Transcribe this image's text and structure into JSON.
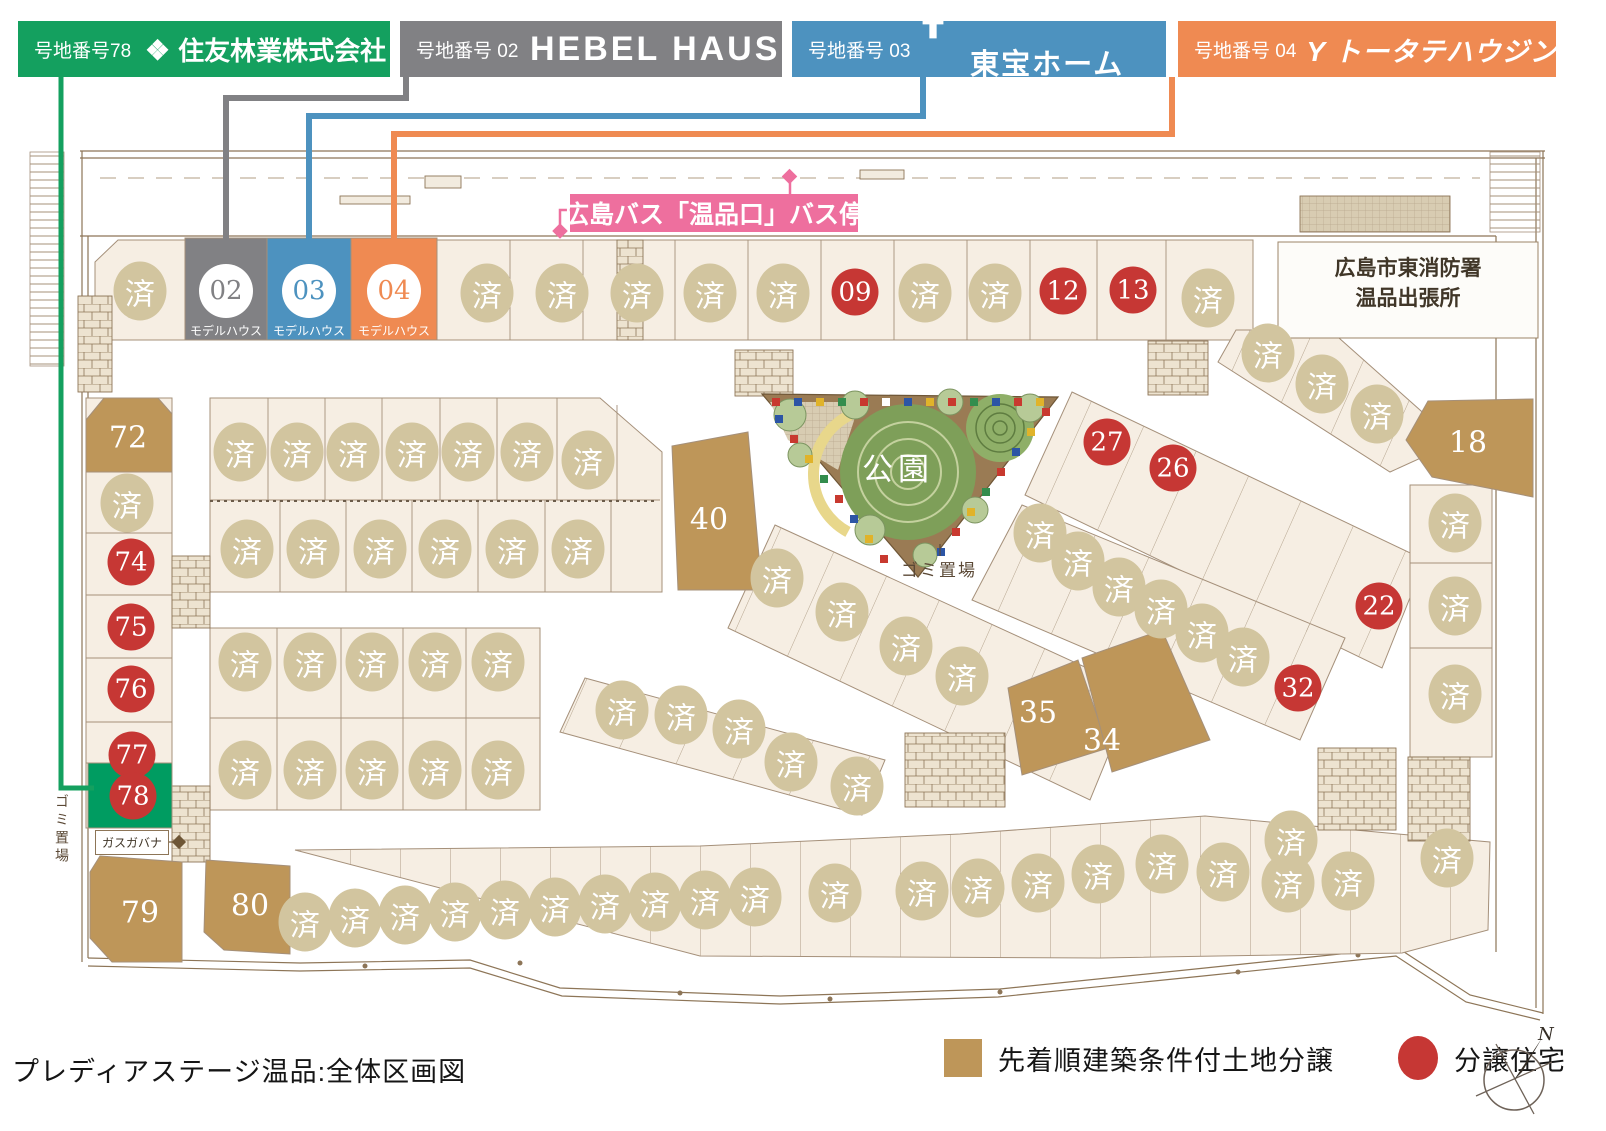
{
  "header": {
    "banners": [
      {
        "id": "sumitomo",
        "lot_label": "号地番号78",
        "company": "住友林業株式会社",
        "logo": "sumitomo-diamond-icon",
        "color": "#14A05F"
      },
      {
        "id": "hebel",
        "lot_label": "号地番号 02",
        "company": "HEBEL HAUS",
        "logo": "",
        "color": "#818184"
      },
      {
        "id": "toho",
        "lot_label": "号地番号 03",
        "company": "東宝ホーム",
        "logo": "toho-home-icon",
        "color": "#4D92BF"
      },
      {
        "id": "totate",
        "lot_label": "号地番号 04",
        "company": "トータテハウジング",
        "logo": "totate-y-icon",
        "color": "#EF8A52"
      }
    ]
  },
  "map": {
    "bus_stop_label": "広島バス「温品口」バス停",
    "bus_stop_color": "#EE6F9E",
    "fire_station": {
      "line1": "広島市東消防署",
      "line2": "温品出張所"
    },
    "park_label": "公園",
    "park_trash_label": "ゴミ置場",
    "left_trash_label": "ゴミ置場",
    "gas_label": "ガスガバナ",
    "model_caption": "モデルハウス",
    "sold_glyph": "済",
    "colors": {
      "sold_circle": "#D2C59F",
      "unit_red": "#C63734",
      "land_tan": "#BE9659",
      "lot78_green": "#009C61"
    },
    "lots": [
      {
        "t": "s",
        "x": 140,
        "y": 291
      },
      {
        "t": "s",
        "x": 487,
        "y": 293
      },
      {
        "t": "s",
        "x": 562,
        "y": 293
      },
      {
        "t": "s",
        "x": 637,
        "y": 293
      },
      {
        "t": "s",
        "x": 710,
        "y": 293
      },
      {
        "t": "s",
        "x": 783,
        "y": 293
      },
      {
        "t": "s",
        "x": 925,
        "y": 293
      },
      {
        "t": "s",
        "x": 995,
        "y": 293
      },
      {
        "t": "s",
        "x": 1208,
        "y": 298
      },
      {
        "t": "s",
        "x": 1268,
        "y": 353
      },
      {
        "t": "s",
        "x": 1322,
        "y": 384
      },
      {
        "t": "s",
        "x": 1377,
        "y": 414
      },
      {
        "t": "s",
        "x": 1455,
        "y": 523
      },
      {
        "t": "s",
        "x": 1455,
        "y": 606
      },
      {
        "t": "s",
        "x": 1455,
        "y": 694
      },
      {
        "t": "s",
        "x": 127,
        "y": 503
      },
      {
        "t": "s",
        "x": 240,
        "y": 452
      },
      {
        "t": "s",
        "x": 297,
        "y": 452
      },
      {
        "t": "s",
        "x": 353,
        "y": 452
      },
      {
        "t": "s",
        "x": 412,
        "y": 452
      },
      {
        "t": "s",
        "x": 468,
        "y": 452
      },
      {
        "t": "s",
        "x": 527,
        "y": 452
      },
      {
        "t": "s",
        "x": 588,
        "y": 460
      },
      {
        "t": "s",
        "x": 247,
        "y": 549
      },
      {
        "t": "s",
        "x": 313,
        "y": 549
      },
      {
        "t": "s",
        "x": 380,
        "y": 549
      },
      {
        "t": "s",
        "x": 445,
        "y": 549
      },
      {
        "t": "s",
        "x": 512,
        "y": 549
      },
      {
        "t": "s",
        "x": 578,
        "y": 549
      },
      {
        "t": "s",
        "x": 777,
        "y": 578
      },
      {
        "t": "s",
        "x": 842,
        "y": 612
      },
      {
        "t": "s",
        "x": 906,
        "y": 646
      },
      {
        "t": "s",
        "x": 962,
        "y": 676
      },
      {
        "t": "s",
        "x": 622,
        "y": 710
      },
      {
        "t": "s",
        "x": 681,
        "y": 715
      },
      {
        "t": "s",
        "x": 739,
        "y": 729
      },
      {
        "t": "s",
        "x": 791,
        "y": 762
      },
      {
        "t": "s",
        "x": 857,
        "y": 786
      },
      {
        "t": "s",
        "x": 1040,
        "y": 533
      },
      {
        "t": "s",
        "x": 1078,
        "y": 561
      },
      {
        "t": "s",
        "x": 1119,
        "y": 587
      },
      {
        "t": "s",
        "x": 1161,
        "y": 609
      },
      {
        "t": "s",
        "x": 1202,
        "y": 633
      },
      {
        "t": "s",
        "x": 1243,
        "y": 657
      },
      {
        "t": "s",
        "x": 245,
        "y": 662
      },
      {
        "t": "s",
        "x": 310,
        "y": 662
      },
      {
        "t": "s",
        "x": 372,
        "y": 662
      },
      {
        "t": "s",
        "x": 435,
        "y": 662
      },
      {
        "t": "s",
        "x": 498,
        "y": 662
      },
      {
        "t": "s",
        "x": 245,
        "y": 770
      },
      {
        "t": "s",
        "x": 310,
        "y": 770
      },
      {
        "t": "s",
        "x": 372,
        "y": 770
      },
      {
        "t": "s",
        "x": 435,
        "y": 770
      },
      {
        "t": "s",
        "x": 498,
        "y": 770
      },
      {
        "t": "s",
        "x": 305,
        "y": 922
      },
      {
        "t": "s",
        "x": 355,
        "y": 918
      },
      {
        "t": "s",
        "x": 405,
        "y": 915
      },
      {
        "t": "s",
        "x": 455,
        "y": 912
      },
      {
        "t": "s",
        "x": 505,
        "y": 910
      },
      {
        "t": "s",
        "x": 555,
        "y": 907
      },
      {
        "t": "s",
        "x": 605,
        "y": 904
      },
      {
        "t": "s",
        "x": 655,
        "y": 902
      },
      {
        "t": "s",
        "x": 705,
        "y": 900
      },
      {
        "t": "s",
        "x": 755,
        "y": 897
      },
      {
        "t": "s",
        "x": 835,
        "y": 893
      },
      {
        "t": "s",
        "x": 922,
        "y": 891
      },
      {
        "t": "s",
        "x": 978,
        "y": 888
      },
      {
        "t": "s",
        "x": 1038,
        "y": 883
      },
      {
        "t": "s",
        "x": 1098,
        "y": 874
      },
      {
        "t": "s",
        "x": 1162,
        "y": 864
      },
      {
        "t": "s",
        "x": 1223,
        "y": 872
      },
      {
        "t": "s",
        "x": 1288,
        "y": 883
      },
      {
        "t": "s",
        "x": 1348,
        "y": 881
      },
      {
        "t": "s",
        "x": 1291,
        "y": 840
      },
      {
        "t": "s",
        "x": 1447,
        "y": 858
      },
      {
        "t": "u",
        "l": "09",
        "x": 855,
        "y": 292
      },
      {
        "t": "u",
        "l": "12",
        "x": 1063,
        "y": 291
      },
      {
        "t": "u",
        "l": "13",
        "x": 1133,
        "y": 290
      },
      {
        "t": "u",
        "l": "22",
        "x": 1379,
        "y": 606
      },
      {
        "t": "u",
        "l": "26",
        "x": 1173,
        "y": 468
      },
      {
        "t": "u",
        "l": "27",
        "x": 1107,
        "y": 442
      },
      {
        "t": "u",
        "l": "32",
        "x": 1298,
        "y": 688
      },
      {
        "t": "u",
        "l": "74",
        "x": 131,
        "y": 562
      },
      {
        "t": "u",
        "l": "75",
        "x": 131,
        "y": 627
      },
      {
        "t": "u",
        "l": "76",
        "x": 131,
        "y": 689
      },
      {
        "t": "u",
        "l": "77",
        "x": 132,
        "y": 755
      },
      {
        "t": "u",
        "l": "78",
        "x": 133,
        "y": 796
      },
      {
        "t": "l",
        "l": "72",
        "x": 128,
        "y": 438
      },
      {
        "t": "l",
        "l": "18",
        "x": 1468,
        "y": 443
      },
      {
        "t": "l",
        "l": "40",
        "x": 709,
        "y": 520
      },
      {
        "t": "l",
        "l": "35",
        "x": 1038,
        "y": 713
      },
      {
        "t": "l",
        "l": "34",
        "x": 1102,
        "y": 741
      },
      {
        "t": "l",
        "l": "79",
        "x": 140,
        "y": 913
      },
      {
        "t": "l",
        "l": "80",
        "x": 250,
        "y": 906
      },
      {
        "t": "m",
        "l": "02",
        "x": 226,
        "y": 291,
        "c": "#818184"
      },
      {
        "t": "m",
        "l": "03",
        "x": 309,
        "y": 291,
        "c": "#4D92BF"
      },
      {
        "t": "m",
        "l": "04",
        "x": 394,
        "y": 291,
        "c": "#EF8A52"
      }
    ]
  },
  "footer": {
    "title": "プレディアステージ温品:全体区画図",
    "legend": [
      {
        "swatch": "land",
        "label": "先着順建築条件付土地分譲"
      },
      {
        "swatch": "unit",
        "label": "分譲住宅"
      }
    ],
    "compass_n": "N"
  }
}
